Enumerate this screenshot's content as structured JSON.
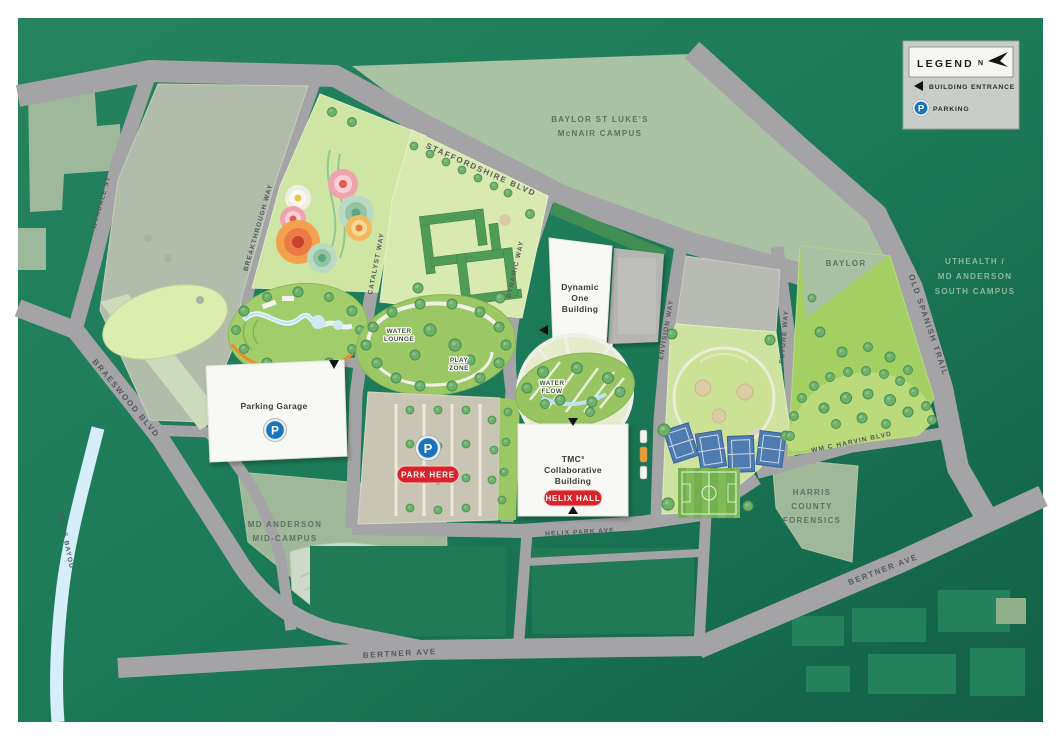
{
  "legend": {
    "title": "LEGEND",
    "north_label": "N",
    "building_entrance_label": "BUILDING ENTRANCE",
    "parking_label": "PARKING"
  },
  "streets": {
    "staffordshire_blvd": "STAFFORDSHIRE BLVD",
    "wyndale_st": "WYNDALE ST",
    "breakthrough_way": "BREAKTHROUGH WAY",
    "catalyst_way": "CATALYST WAY",
    "dynamic_way": "DYNAMIC WAY",
    "envision_way": "ENVISION WAY",
    "future_way": "FUTURE WAY",
    "old_spanish_trail": "OLD SPANISH TRAIL",
    "braeswood_blvd": "BRAESWOOD BLVD",
    "brays_bayou": "BRAYS BAYOU",
    "bertner_ave_south": "BERTNER AVE",
    "bertner_ave_east": "BERTNER AVE",
    "helix_park_ave": "HELIX PARK AVE",
    "wm_c_harvin_blvd": "WM C HARVIN BLVD"
  },
  "campuses": {
    "baylor_st_lukes": {
      "line1": "BAYLOR ST LUKE'S",
      "line2": "McNAIR CAMPUS"
    },
    "uthealth": {
      "line1": "UTHEALTH /",
      "line2": "MD ANDERSON",
      "line3": "SOUTH CAMPUS"
    },
    "md_anderson_mid": {
      "line1": "MD ANDERSON",
      "line2": "MID-CAMPUS"
    },
    "harris_county_forensics": {
      "line1": "HARRIS",
      "line2": "COUNTY",
      "line3": "FORENSICS"
    },
    "baylor": "BAYLOR"
  },
  "buildings": {
    "parking_garage": "Parking Garage",
    "dynamic_one": {
      "line1": "Dynamic",
      "line2": "One",
      "line3": "Building"
    },
    "tmc3": {
      "line1": "TMC³",
      "line2": "Collaborative",
      "line3": "Building"
    },
    "helix_hall_badge": "HELIX HALL"
  },
  "pois": {
    "park_here_badge": "PARK HERE",
    "water_lounge": {
      "line1": "WATER",
      "line2": "LOUNGE"
    },
    "play_zone": {
      "line1": "PLAY",
      "line2": "ZONE"
    },
    "water_flow": {
      "line1": "WATER",
      "line2": "FLOW"
    },
    "parking_p": "P"
  },
  "colors": {
    "background_green": "#1c7a58",
    "campus_sage": "#a9c2a4",
    "road_gray": "#a4a4a6",
    "parcel_light_green": "#d5e7aa",
    "garden_green": "#9cc765",
    "hedge_green": "#4f9b57",
    "water_blue": "#d6eef9",
    "building_white": "#f8f8f5",
    "badge_red": "#d8232a",
    "parking_blue": "#1a74bc"
  }
}
